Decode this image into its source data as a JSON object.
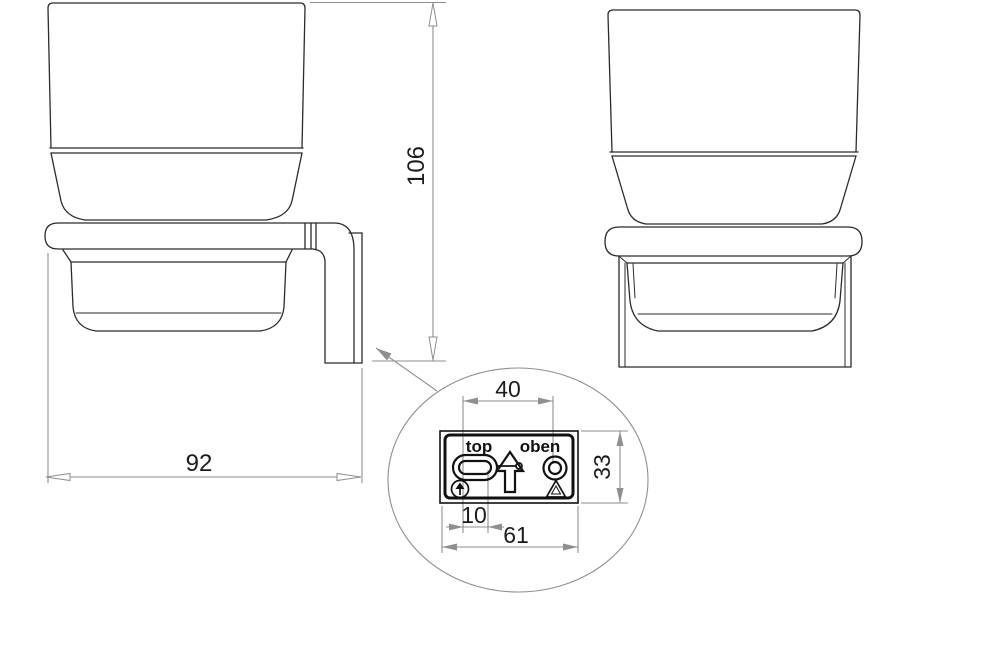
{
  "drawing": {
    "dimensions": {
      "overall_height": "106",
      "overall_depth": "92",
      "hole_spacing": "40",
      "plate_height": "33",
      "slot_length": "10",
      "plate_width": "61"
    },
    "plate": {
      "label_left": "top",
      "label_right": "oben"
    },
    "colors": {
      "object_line": "#2b2b2b",
      "plate_line": "#111111",
      "dimension_line": "#8f8f8f",
      "dimension_text": "#1c1c1c",
      "background": "#ffffff"
    }
  }
}
